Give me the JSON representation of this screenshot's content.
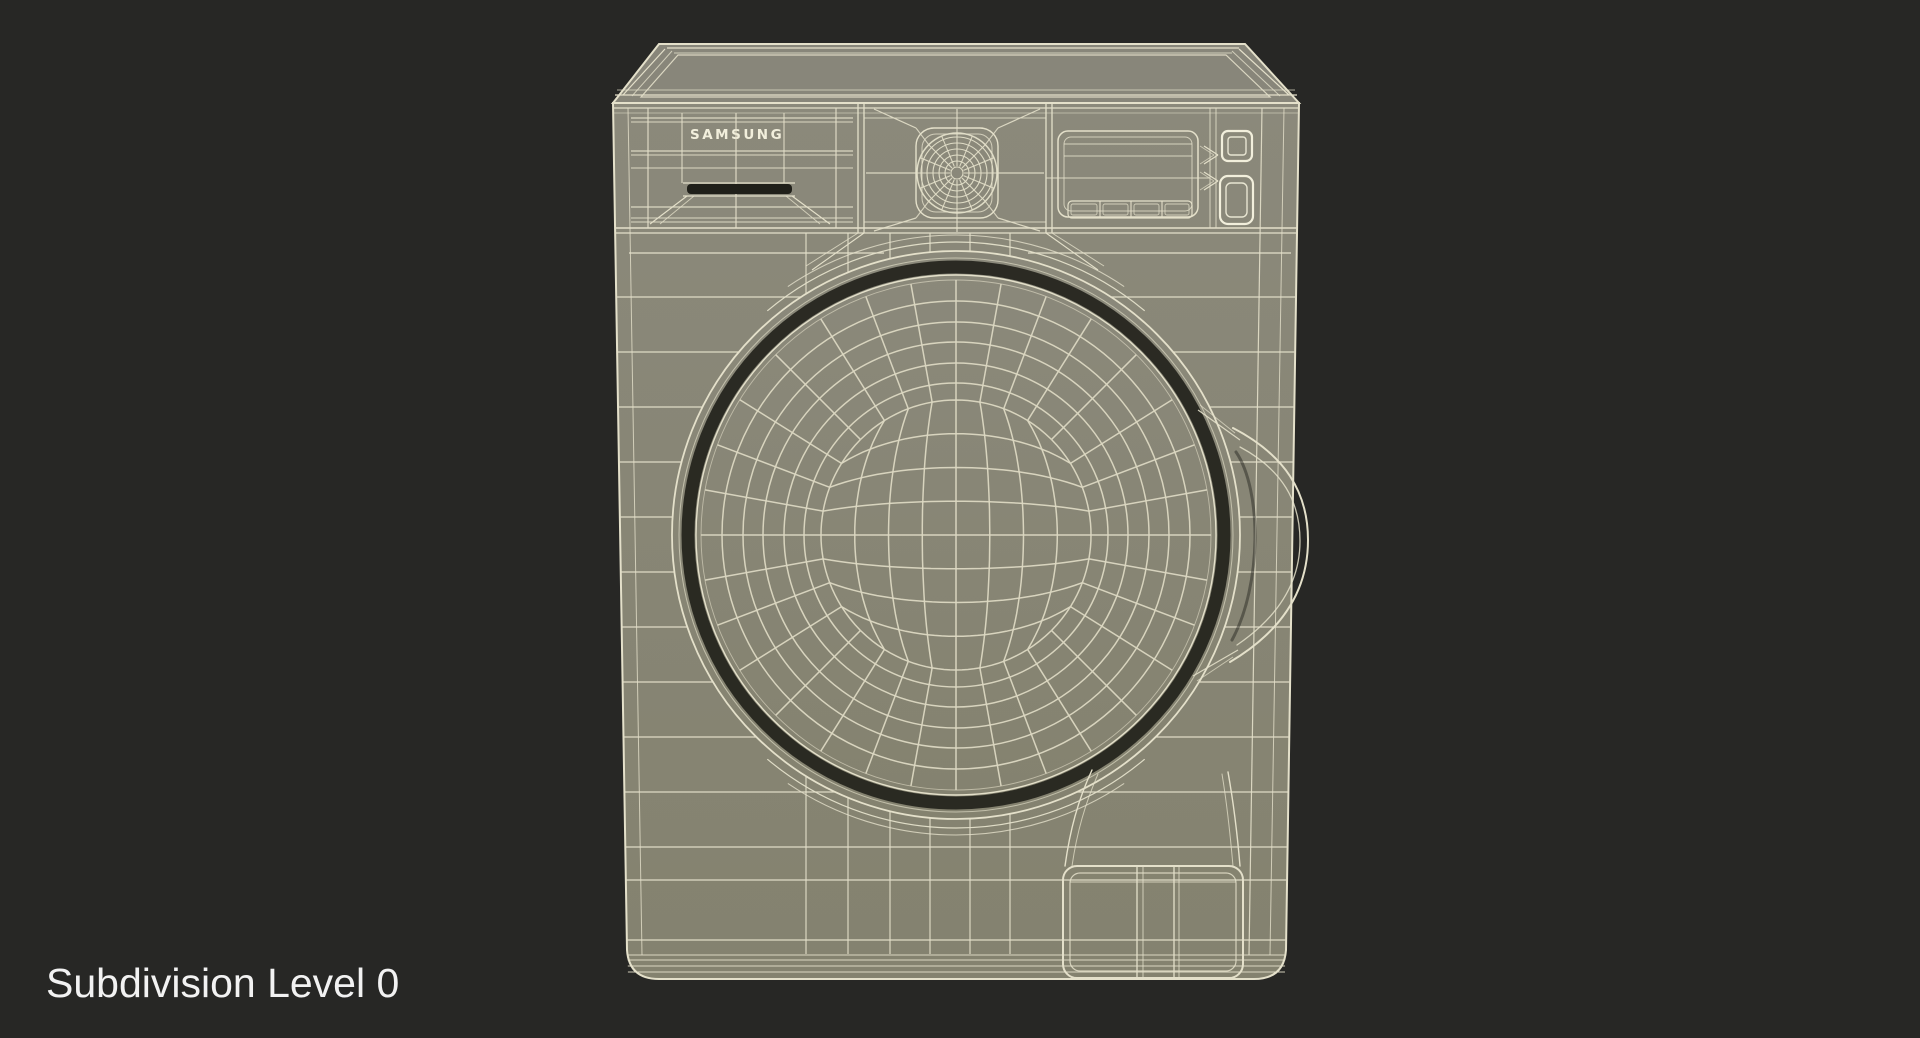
{
  "caption": "Subdivision Level 0",
  "brand": "SAMSUNG",
  "render": {
    "subject": "washing-machine-3d-wireframe",
    "view": "front",
    "subdivision_level": 0
  },
  "colors": {
    "background": "#272725",
    "surface": "#8b897b",
    "surface_bottom": "#84826f",
    "surface_top": "#88867a",
    "wire": "#e4e0ca",
    "wire_bright": "#f2efdc",
    "wire_dim": "#dcd8c2",
    "recess_dark": "#20201a",
    "caption_text": "#f2f2f2"
  }
}
